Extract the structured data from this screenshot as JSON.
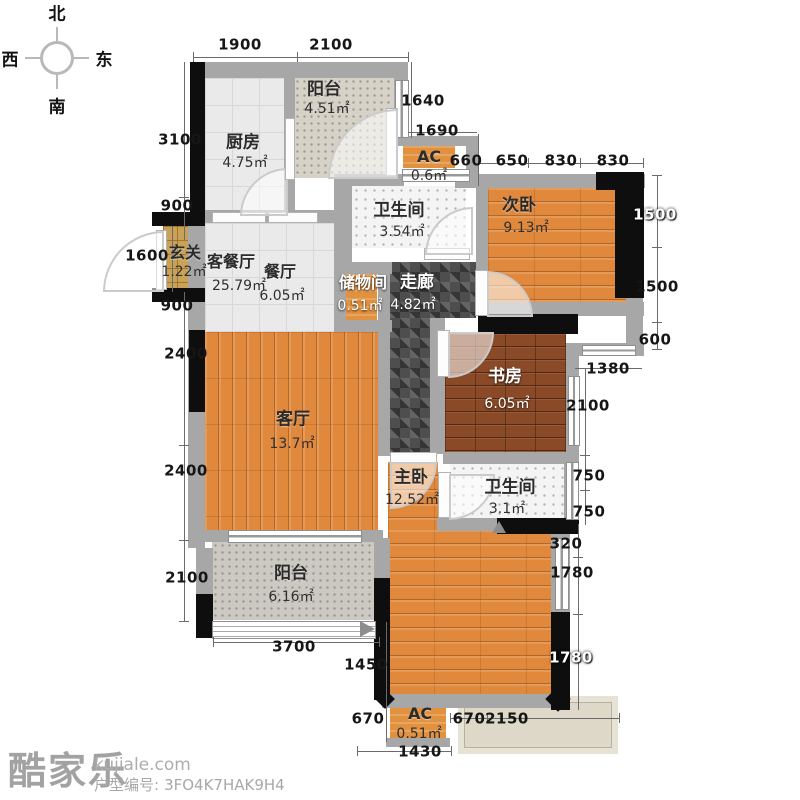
{
  "compass": {
    "north": "北",
    "west": "西",
    "east": "东",
    "south": "南"
  },
  "rooms": {
    "balcony_top": {
      "name": "阳台",
      "area": "4.51㎡"
    },
    "kitchen": {
      "name": "厨房",
      "area": "4.75㎡"
    },
    "ac_top": {
      "name": "AC",
      "area": "0.6㎡"
    },
    "bath_top": {
      "name": "卫生间",
      "area": "3.54㎡"
    },
    "bedroom2": {
      "name": "次卧",
      "area": "9.13㎡"
    },
    "entry": {
      "name": "玄关",
      "area": "1.22㎡"
    },
    "living_dining": {
      "name": "客餐厅",
      "area": "25.79㎡"
    },
    "dining": {
      "name": "餐厅",
      "area": "6.05㎡"
    },
    "storage": {
      "name": "储物间",
      "area": "0.51㎡"
    },
    "corridor": {
      "name": "走廊",
      "area": "4.82㎡"
    },
    "study": {
      "name": "书房",
      "area": "6.05㎡"
    },
    "living": {
      "name": "客厅",
      "area": "13.7㎡"
    },
    "master": {
      "name": "主卧",
      "area": "12.52㎡"
    },
    "bath_bottom": {
      "name": "卫生间",
      "area": "3.1㎡"
    },
    "balcony_bottom": {
      "name": "阳台",
      "area": "6.16㎡"
    },
    "ac_bottom": {
      "name": "AC",
      "area": "0.51㎡"
    }
  },
  "dims": {
    "top_1900": "1900",
    "top_2100": "2100",
    "r_1640": "1640",
    "r_1690": "1690",
    "n_660": "660",
    "n_650": "650",
    "n_830a": "830",
    "n_830b": "830",
    "l_3100": "3100",
    "l_900a": "900",
    "l_1600": "1600",
    "l_900b": "900",
    "l_2400a": "2400",
    "l_2400b": "2400",
    "l_2100": "2100",
    "r_1500a": "1500",
    "r_1500b": "1500",
    "r_600": "600",
    "r_1380": "1380",
    "r_2100": "2100",
    "r_750a": "750",
    "r_750b": "750",
    "r_320": "320",
    "r_1780a": "1780",
    "r_1780b": "1780",
    "b_3700": "3700",
    "b_1450": "1450",
    "b_670a": "670",
    "b_670b": "670",
    "b_2150": "2150",
    "b_1430": "1430"
  },
  "footer": {
    "logo": "酷家乐",
    "site": "kujiale.com",
    "code_label": "户型编号:",
    "code": "3FO4K7HAK9H4"
  },
  "colors": {
    "wood": "#e0893d",
    "wood_dark": "#8a4a27",
    "wall": "#a7a7a7",
    "wall_black": "#0e0e0e",
    "accent_orange": "#e2913f",
    "entry_tan": "#c9a257"
  }
}
